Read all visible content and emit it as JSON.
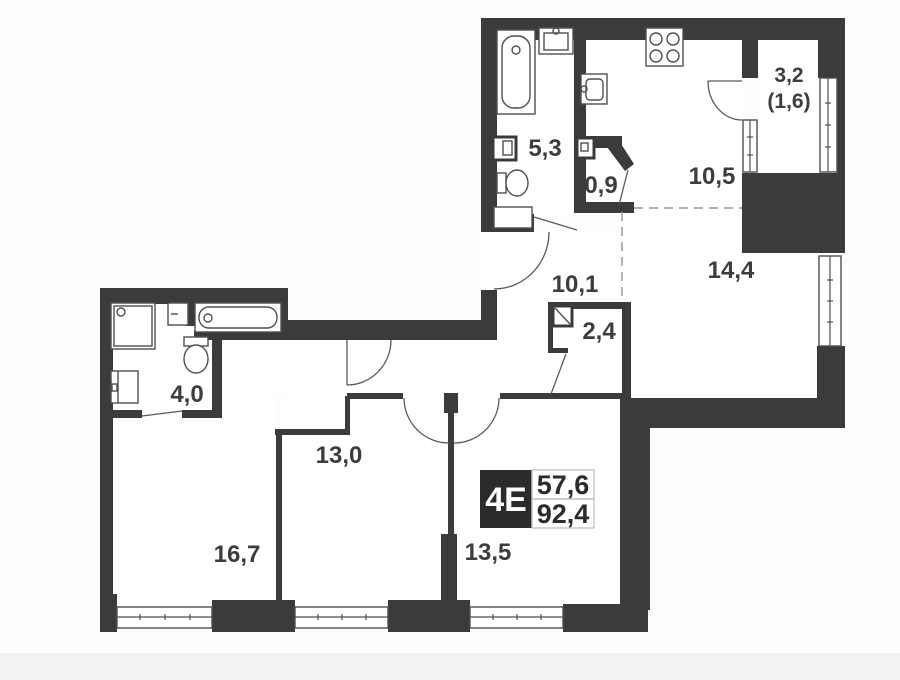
{
  "page": {
    "background": "#fdfdfd",
    "footer_band_color": "#f3f3f3"
  },
  "plan": {
    "badge": {
      "type": "4E",
      "upper_value": "57,6",
      "lower_value": "92,4"
    },
    "rooms": [
      {
        "name": "bathroom-upper",
        "area": "5,3"
      },
      {
        "name": "wc-small",
        "area": "0,9"
      },
      {
        "name": "kitchen",
        "area": "10,5"
      },
      {
        "name": "balcony",
        "area": "3,2",
        "area_reduced": "(1,6)"
      },
      {
        "name": "living-room",
        "area": "14,4"
      },
      {
        "name": "hallway",
        "area": "10,1"
      },
      {
        "name": "closet",
        "area": "2,4"
      },
      {
        "name": "bathroom-lower",
        "area": "4,0"
      },
      {
        "name": "bedroom-middle",
        "area": "13,0"
      },
      {
        "name": "room-bottom-left",
        "area": "16,7"
      },
      {
        "name": "room-bottom-right",
        "area": "13,5"
      }
    ],
    "colors": {
      "wall": "#3b3b3b",
      "fixture_line": "#4f4f4f",
      "dashed_line": "#a6a6a6",
      "label_text": "#3d3d3d",
      "badge_bg": "#2b2b2b",
      "badge_text": "#ffffff"
    }
  }
}
